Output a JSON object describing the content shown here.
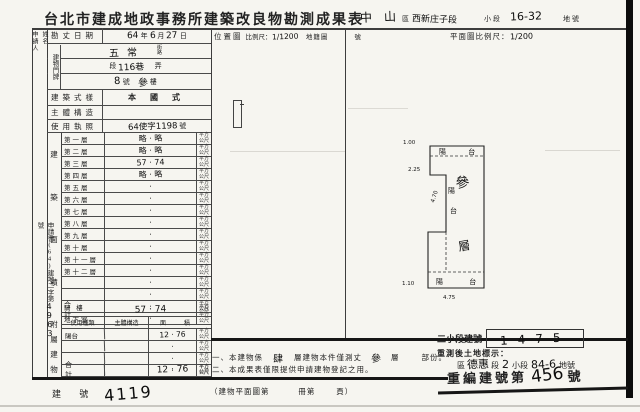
{
  "title": {
    "main": "台北市建成地政事務所建築改良物勘測成果表",
    "district": "中山",
    "district_label": "區",
    "section": "西新庄子段",
    "subsection_label": "小段",
    "parcel": "16-32",
    "parcel_label": "地號"
  },
  "left": {
    "applicant_label": "申請人",
    "applicant_name_label": "姓名",
    "application_doc": {
      "prefix": "申請書(64)建地二字第",
      "number": "4963",
      "suffix": "號"
    },
    "rows": {
      "survey_date": {
        "label": "勘丈日期",
        "year": "64",
        "year_label": "年",
        "month": "6",
        "month_label": "月",
        "day": "27",
        "day_label": "日"
      },
      "address_group_label": "建物門牌",
      "street": {
        "value": "五常",
        "unit_top": "街",
        "unit_bottom": "路"
      },
      "lane": {
        "seg_label": "段",
        "value": "116巷",
        "unit_label": "弄"
      },
      "door": {
        "no": "8",
        "no_label": "號",
        "floor": "參",
        "floor_label": "樓"
      },
      "style": {
        "label": "建築式樣",
        "value": "本 國 式"
      },
      "structure": {
        "label": "主體構造",
        "value": ""
      },
      "license": {
        "label": "使用執照",
        "value": "64使字1198",
        "suffix": "號"
      }
    },
    "floors": {
      "side_label": [
        "建",
        "築",
        "面",
        "積"
      ],
      "unit_top": "平方",
      "unit_bottom": "公尺",
      "rows": [
        {
          "label": "第一層",
          "value": "略 · 略"
        },
        {
          "label": "第二層",
          "value": "略 · 略"
        },
        {
          "label": "第三層",
          "value": "57 · 74"
        },
        {
          "label": "第四層",
          "value": "略 · 略"
        },
        {
          "label": "第五層",
          "value": "·"
        },
        {
          "label": "第六層",
          "value": "·"
        },
        {
          "label": "第七層",
          "value": "·"
        },
        {
          "label": "第八層",
          "value": "·"
        },
        {
          "label": "第九層",
          "value": "·"
        },
        {
          "label": "第十層",
          "value": "·"
        },
        {
          "label": "第十一層",
          "value": "·"
        },
        {
          "label": "第十二層",
          "value": "·"
        },
        {
          "label": "",
          "value": "·"
        },
        {
          "label": "",
          "value": "·"
        },
        {
          "label": "騎 樓",
          "value": "·"
        },
        {
          "label": "地下室",
          "value": "·"
        }
      ],
      "total_label": "合 計",
      "total_value": "57 · 74"
    },
    "annex": {
      "side_label": [
        "附",
        "屬",
        "建",
        "物"
      ],
      "headers": {
        "use": "使用種類",
        "structure": "主體構造",
        "area": "面積"
      },
      "rows": [
        {
          "use": "陽台",
          "structure": "",
          "area": "12 · 76"
        },
        {
          "use": "",
          "structure": "",
          "area": "·"
        },
        {
          "use": "",
          "structure": "",
          "area": "·"
        },
        {
          "use": "",
          "structure": "",
          "area": "·"
        }
      ],
      "total_label": "合 計",
      "total_area": "12 · 76"
    },
    "building_no": {
      "label": "建 號",
      "value": "4119"
    }
  },
  "location": {
    "label": "位置圖",
    "scale_label": "比例尺：",
    "scale": "1/1200",
    "cadastral_label": "地籍圖",
    "no_label": "號"
  },
  "plan": {
    "scale_label": "平面圖比例尺：",
    "scale": "1/200",
    "labels": {
      "balcony_top": "陽 台",
      "balcony_side": [
        "陽",
        "台"
      ],
      "floor_chars": [
        "參",
        "層"
      ],
      "balcony_bottom": "陽 台"
    },
    "dims": {
      "top_left": "1.00",
      "left_upper": "2.25",
      "notch": "4.70",
      "bottom_left": "1.10",
      "bottom": "4.75"
    }
  },
  "notes": {
    "n1_prefix": "一、本建物係",
    "n1_floors": "肆",
    "n1_mid": "層建物本件僅測丈",
    "n1_measured": "參",
    "n1_unit": "層",
    "n1_suffix": "部份。",
    "n2": "二、本成果表僅限提供申請建物登記之用。",
    "n3_prefix": "（建物平面圖第",
    "n3_mid": "冊第",
    "n3_suffix": "頁）"
  },
  "resurvey": {
    "sub_label": "二小段建號",
    "boxed_no": "1475",
    "line1": "重測後土地標示：",
    "district_label": "區",
    "section": "德惠",
    "section_label": "段",
    "subsection": "2",
    "subsection_label": "小段",
    "parcel": "84-6",
    "parcel_label": "地號",
    "renum_prefix": "重編建號第",
    "renum_no": "456",
    "renum_suffix": "號"
  }
}
